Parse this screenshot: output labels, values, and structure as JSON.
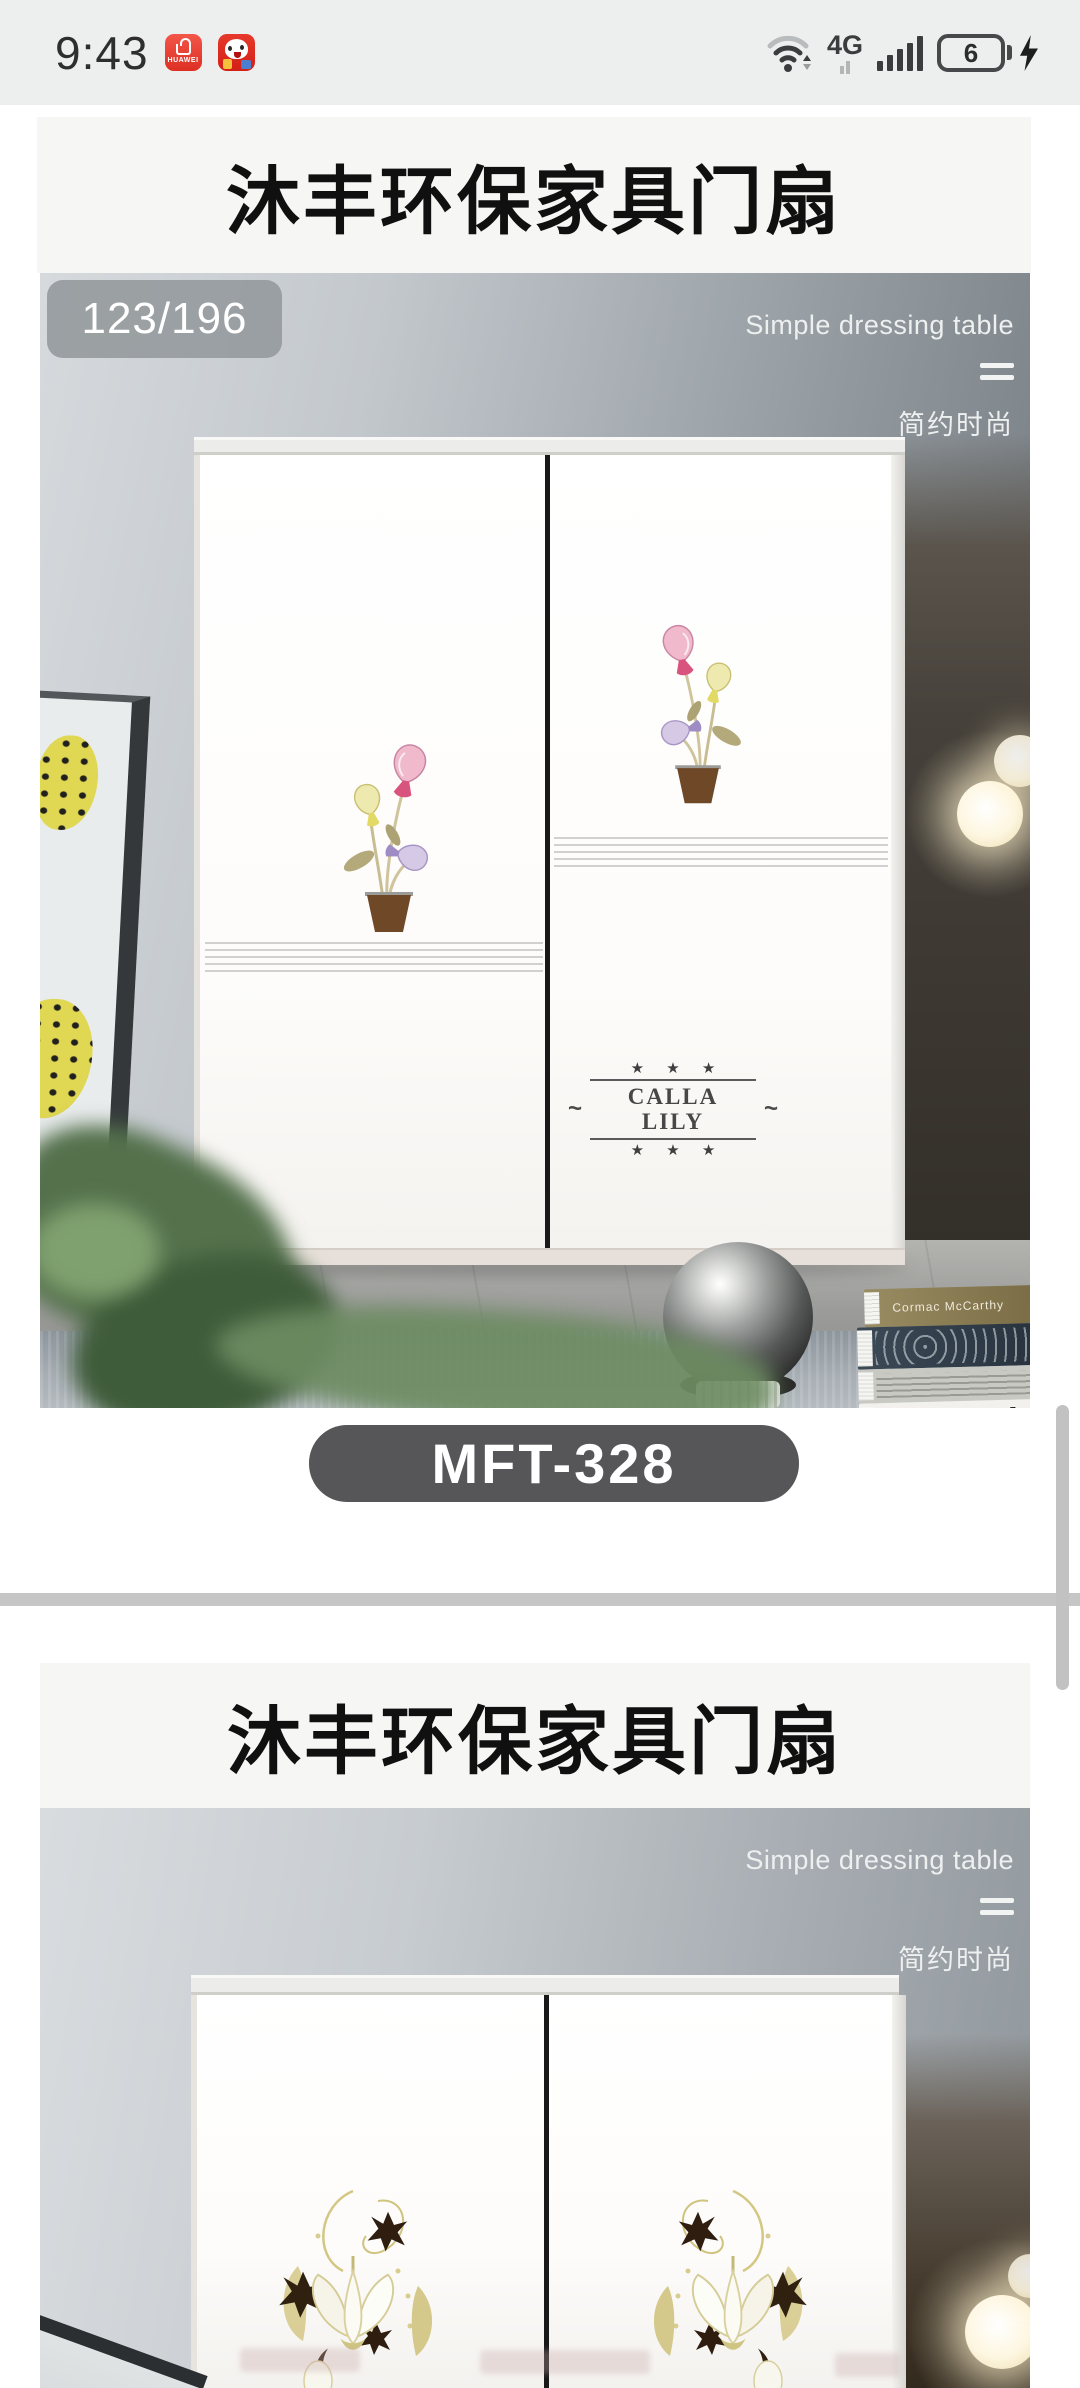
{
  "status_bar": {
    "time": "9:43",
    "huawei_icon_label": "HUAWEI",
    "network_type": "4G",
    "battery_level": "6"
  },
  "card1": {
    "title": "沐丰环保家具门扇",
    "counter": "123/196",
    "model": "MFT-328",
    "photo": {
      "subtitle_en": "Simple dressing table",
      "subtitle_zh": "简约时尚",
      "decal": {
        "stars_top": "★ ★ ★",
        "prefix": "~",
        "name": "CALLA LILY",
        "suffix": "~",
        "stars_bottom": "★ ★ ★"
      },
      "books": {
        "top_author": "Cormac McCarthy",
        "bottom_label": "Andrew Zuckerman",
        "bottom_title": "Bird"
      }
    }
  },
  "card2": {
    "title": "沐丰环保家具门扇",
    "photo": {
      "subtitle_en": "Simple dressing table",
      "subtitle_zh": "简约时尚"
    }
  },
  "colors": {
    "status_bar_bg": "#edefee",
    "card_header_bg": "#f6f6f5",
    "counter_badge": "#969b9e",
    "model_badge": "#565659",
    "divider": "#c6c6c6",
    "app_icon_red": "#e0392c"
  }
}
